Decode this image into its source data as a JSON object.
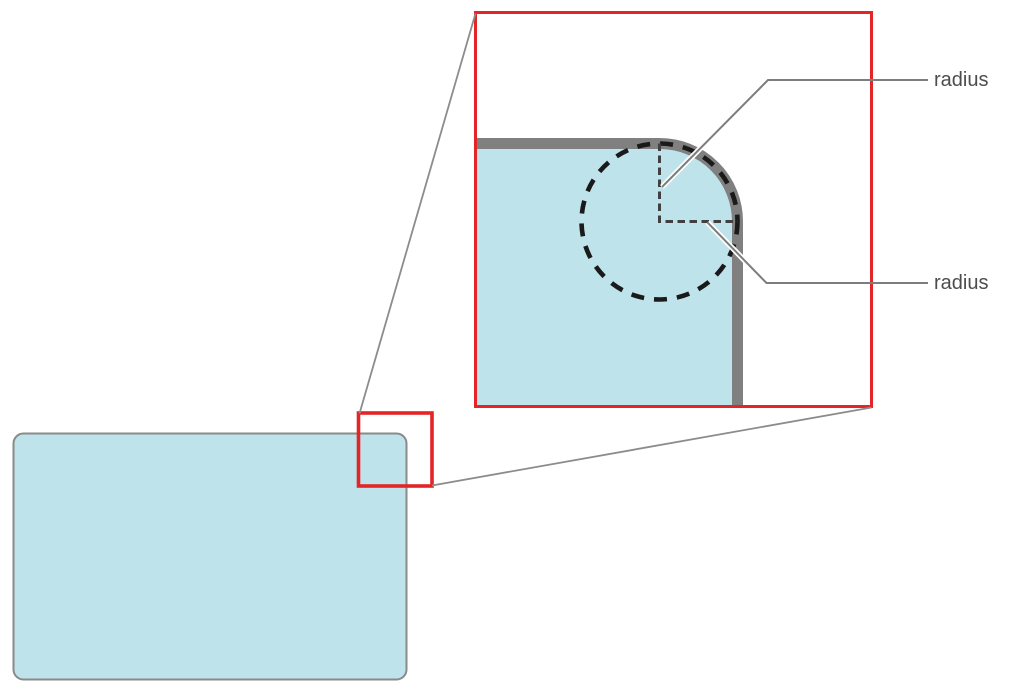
{
  "diagram": {
    "description": "corner-radius-zoom-callout-diagram",
    "labels": {
      "radius_top": "radius",
      "radius_bottom": "radius"
    },
    "colors": {
      "background": "#ffffff",
      "shape_fill": "#bfe3ea",
      "shape_border": "#808080",
      "highlight_red": "#e42527",
      "dashed_circle": "#1a1a1a",
      "dashed_radius_lines": "#404040",
      "leader_line": "#7d7d7d",
      "leader_casing": "#ffffff",
      "connector_line": "#8c8c8c",
      "small_rect_border": "#8a8a8a",
      "label_text": "#4d4d4d"
    }
  }
}
